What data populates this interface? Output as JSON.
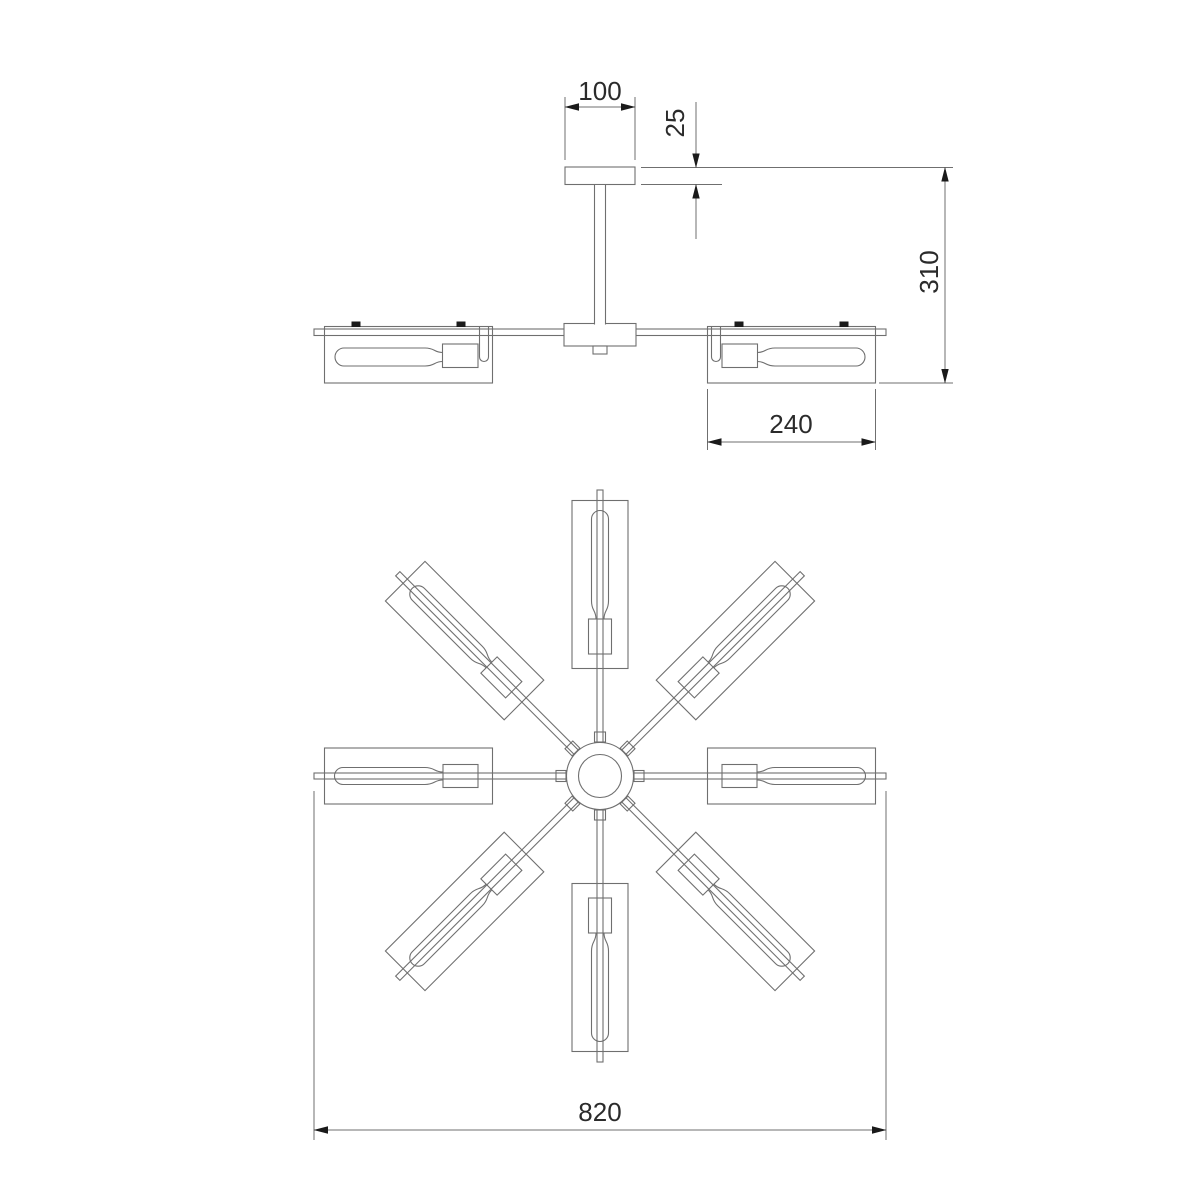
{
  "drawing": {
    "kind": "technical-dimension-drawing",
    "dims": {
      "canopy_width": "100",
      "canopy_height": "25",
      "overall_height": "310",
      "shade_length": "240",
      "overall_width": "820"
    },
    "colors": {
      "background": "#ffffff",
      "line": "#6f6f6f",
      "dim_text": "#2b2b2b",
      "arrow": "#1a1a1a"
    }
  }
}
